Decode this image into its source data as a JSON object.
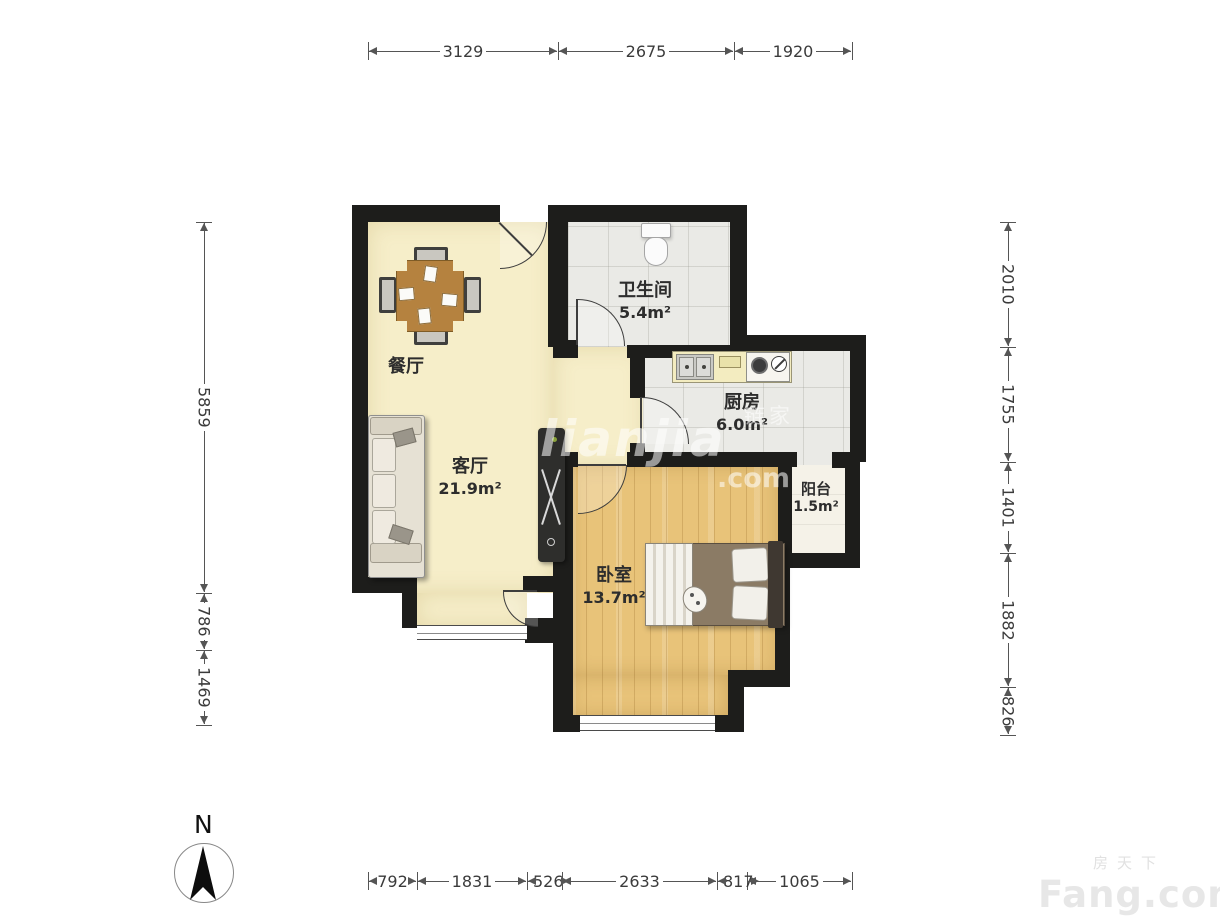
{
  "compass": {
    "label": "N"
  },
  "rooms": [
    {
      "id": "dining",
      "name": "餐厅",
      "area": ""
    },
    {
      "id": "living",
      "name": "客厅",
      "area": "21.9m²"
    },
    {
      "id": "bathroom",
      "name": "卫生间",
      "area": "5.4m²"
    },
    {
      "id": "kitchen",
      "name": "厨房",
      "area": "6.0m²"
    },
    {
      "id": "balcony",
      "name": "阳台",
      "area": "1.5m²"
    },
    {
      "id": "bedroom",
      "name": "卧室",
      "area": "13.7m²"
    }
  ],
  "dimensions": {
    "top": [
      "3129",
      "2675",
      "1920"
    ],
    "bottom": [
      "792",
      "1831",
      "526",
      "2633",
      "817",
      "1065"
    ],
    "left": [
      "5859",
      "786",
      "1469"
    ],
    "right": [
      "2010",
      "1755",
      "1401",
      "1882",
      "826"
    ]
  },
  "watermarks": {
    "center": {
      "brand": "lianjia",
      "suffix": ".com",
      "cjk": "链家"
    },
    "corner": {
      "cjk": "房天下",
      "brand": "Fang.com"
    }
  },
  "colors": {
    "wall": "#1d1d1b",
    "floor_cream": "#f6eec9",
    "floor_tile": "#eaeae6",
    "floor_wood": "#e8c379",
    "dim_line": "#555555"
  }
}
